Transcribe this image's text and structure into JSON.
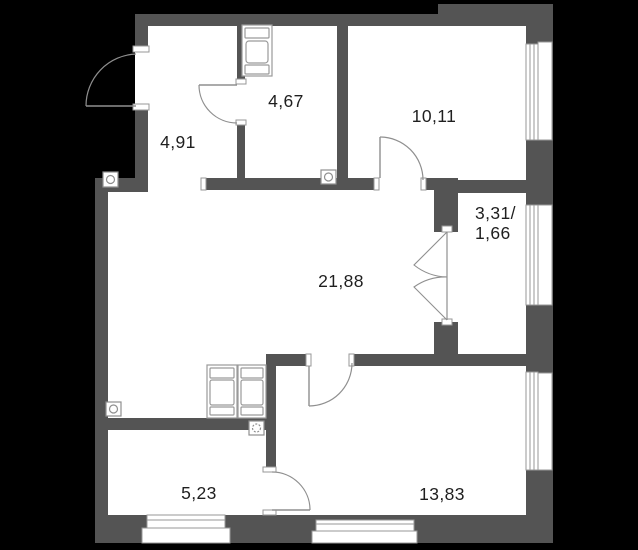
{
  "floor_plan": {
    "type": "apartment-floor-plan",
    "rooms": [
      {
        "key": "hallway",
        "area_label": "4,91"
      },
      {
        "key": "bathroom",
        "area_label": "4,67"
      },
      {
        "key": "bedroom",
        "area_label": "10,11"
      },
      {
        "key": "balcony",
        "area_label_line1": "3,31/",
        "area_label_line2": "1,66"
      },
      {
        "key": "living-room",
        "area_label": "21,88"
      },
      {
        "key": "kitchen",
        "area_label": "5,23"
      },
      {
        "key": "room-2",
        "area_label": "13,83"
      }
    ],
    "colors": {
      "background": "#000000",
      "wall": "#545454",
      "floor": "#ffffff",
      "line": "#979797",
      "text": "#1f1f1f"
    }
  }
}
